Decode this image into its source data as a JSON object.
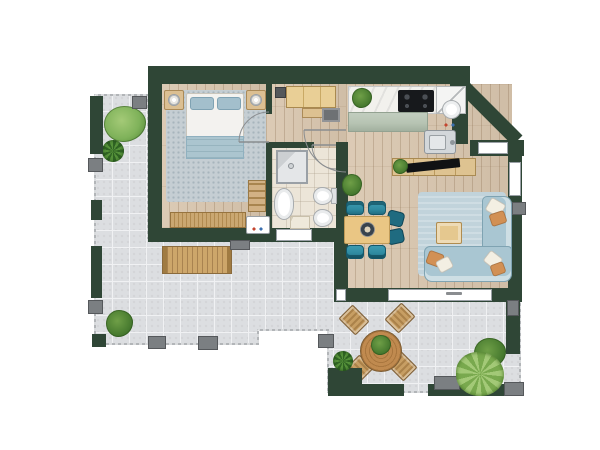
{
  "meta": {
    "type": "architectural-floor-plan",
    "view": "top-down",
    "text_labels_visible": "none (one illegible dimension mark on lower window)"
  },
  "palette": {
    "white": "#ffffff",
    "wall": "#2f4636",
    "woodBase": "#d8c5ad",
    "tileBase": "#dcdee1",
    "tileLine": "#f0f1f3",
    "bathBase": "#ece5d8",
    "rugBed": "#c5ced3",
    "duvet": "#f3f2ef",
    "bedBlanket": "#abc5cf",
    "bedPillow": "#a3bfcc",
    "sofaBody": "#a9c6d2",
    "sofaEdge": "#7fa3b2",
    "sofaRug": "#c1d3db",
    "pillowOrange": "#d29054",
    "pillowCream": "#f3efe3",
    "teal": "#2e8ba1",
    "tealDark": "#14576a",
    "tableWood": "#eac684",
    "marble": "#f2f1ed",
    "sage": "#b7c4b3",
    "steel": "#d3d7da",
    "cooktop": "#17191c",
    "wardrobe": "#e9cf96",
    "outdoorWood": "#c79e63",
    "benchWood": "#cda66a",
    "plantLight": "#7fb25a",
    "plantDark": "#477a2f",
    "pillarGray": "#7b7f82",
    "matGray": "#6e7174",
    "frameGray": "#9aa0a6"
  },
  "rooms": [
    {
      "id": "bedroom",
      "furniture": [
        "double-bed",
        "two-pillows",
        "foot-blanket",
        "area-rug",
        "nightstand-left",
        "nightstand-right",
        "table-lamp-left",
        "table-lamp-right",
        "ladder-shelf",
        "dresser",
        "washing-machine"
      ]
    },
    {
      "id": "hallway",
      "furniture": [
        "wardrobe",
        "bench",
        "doormat",
        "wall-unit"
      ]
    },
    {
      "id": "bathroom",
      "furniture": [
        "shower",
        "washbasin",
        "toilet",
        "bidet",
        "bathmat",
        "door-swing"
      ]
    },
    {
      "id": "kitchen",
      "furniture": [
        "marble-counter",
        "cooktop-4-burners",
        "corner-cabinet",
        "round-basin",
        "steel-sink",
        "sage-island-counter",
        "potted-plant"
      ]
    },
    {
      "id": "living-room",
      "furniture": [
        "sideboard",
        "tv",
        "potted-plant",
        "dining-table",
        "teal-chairs-x4",
        "dark-chairs-x2",
        "centerpiece",
        "l-shaped-sofa",
        "throw-pillows-x6",
        "coffee-table",
        "area-rug"
      ]
    },
    {
      "id": "terrace-main",
      "furniture": [
        "wood-bench",
        "bushes",
        "starburst-plant",
        "railing",
        "pillars"
      ]
    },
    {
      "id": "terrace-lower",
      "furniture": [
        "round-table",
        "outdoor-chairs-x4",
        "table-plant",
        "planter-box",
        "bushes",
        "palm-plant",
        "pillars"
      ]
    }
  ]
}
